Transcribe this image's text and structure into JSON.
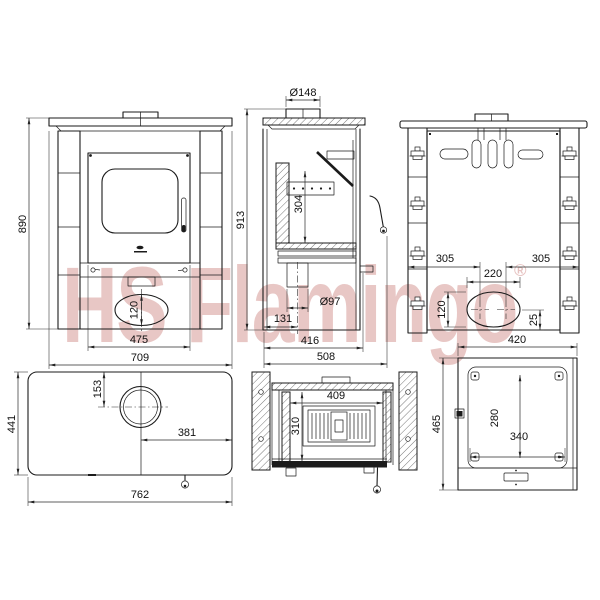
{
  "watermark": {
    "text": "HS Flamingo",
    "registered": "®",
    "color": "#b03a34"
  },
  "views": {
    "front": {
      "dims": {
        "height": "890",
        "ash_oval_height": "120",
        "door_width": "475",
        "width": "709"
      }
    },
    "side_section": {
      "dims": {
        "flue_diameter": "Ø148",
        "total_height": "913",
        "firebox_height": "304",
        "outlet_diameter": "Ø97",
        "outlet_offset": "131",
        "body_depth": "416",
        "total_depth": "508"
      }
    },
    "rear": {
      "dims": {
        "left_offset": "305",
        "right_offset": "305",
        "outlet_width": "220",
        "outlet_height": "120",
        "outlet_drop": "25"
      }
    },
    "top": {
      "dims": {
        "depth": "441",
        "flue_center_from_edge": "153",
        "flue_center_to_side": "381",
        "width": "762"
      }
    },
    "firebox_plan": {
      "dims": {
        "width": "409",
        "depth": "310"
      }
    },
    "bottom": {
      "dims": {
        "width": "420",
        "depth": "465",
        "inner_depth": "280",
        "inner_width": "340"
      }
    }
  }
}
